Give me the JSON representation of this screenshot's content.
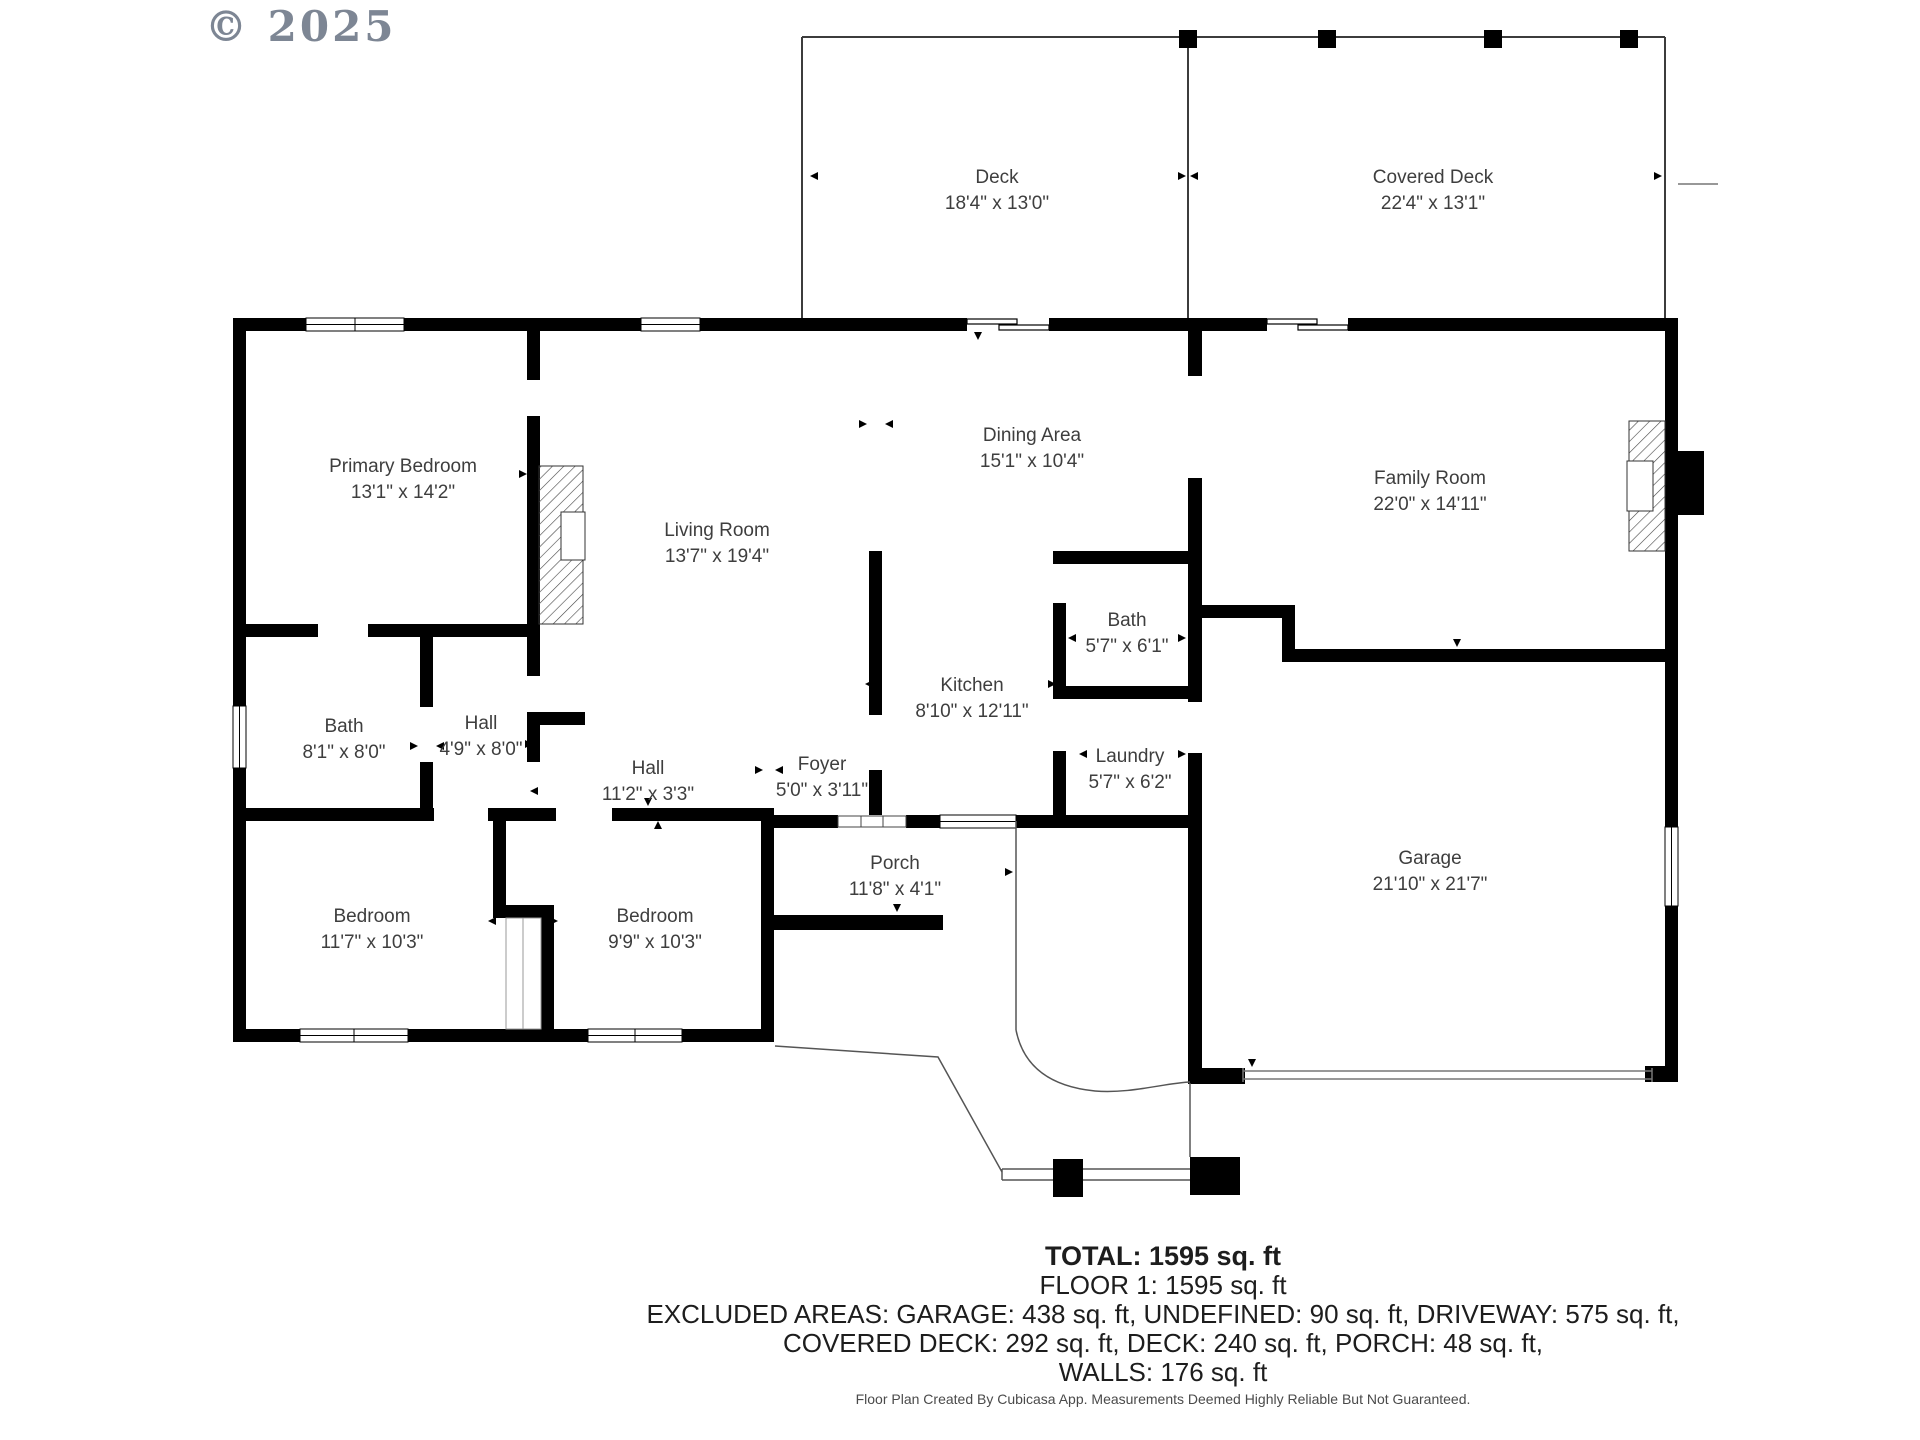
{
  "copyright": "© 2025",
  "rooms": [
    {
      "id": "deck",
      "name": "Deck",
      "dims": "18'4\" x 13'0\"",
      "cx": 997,
      "cy": 191
    },
    {
      "id": "covered-deck",
      "name": "Covered Deck",
      "dims": "22'4\" x 13'1\"",
      "cx": 1433,
      "cy": 191
    },
    {
      "id": "primary-bedroom",
      "name": "Primary Bedroom",
      "dims": "13'1\" x 14'2\"",
      "cx": 403,
      "cy": 480
    },
    {
      "id": "dining-area",
      "name": "Dining Area",
      "dims": "15'1\" x 10'4\"",
      "cx": 1032,
      "cy": 449
    },
    {
      "id": "family-room",
      "name": "Family Room",
      "dims": "22'0\" x 14'11\"",
      "cx": 1430,
      "cy": 492
    },
    {
      "id": "living-room",
      "name": "Living Room",
      "dims": "13'7\" x 19'4\"",
      "cx": 717,
      "cy": 544
    },
    {
      "id": "bath-upper",
      "name": "Bath",
      "dims": "5'7\" x 6'1\"",
      "cx": 1127,
      "cy": 634
    },
    {
      "id": "kitchen",
      "name": "Kitchen",
      "dims": "8'10\" x 12'11\"",
      "cx": 972,
      "cy": 699
    },
    {
      "id": "bath-left",
      "name": "Bath",
      "dims": "8'1\" x 8'0\"",
      "cx": 344,
      "cy": 740
    },
    {
      "id": "hall-small",
      "name": "Hall",
      "dims": "4'9\" x 8'0\"",
      "cx": 481,
      "cy": 737
    },
    {
      "id": "hall-long",
      "name": "Hall",
      "dims": "11'2\" x 3'3\"",
      "cx": 648,
      "cy": 782
    },
    {
      "id": "foyer",
      "name": "Foyer",
      "dims": "5'0\" x 3'11\"",
      "cx": 822,
      "cy": 778
    },
    {
      "id": "laundry",
      "name": "Laundry",
      "dims": "5'7\" x 6'2\"",
      "cx": 1130,
      "cy": 770
    },
    {
      "id": "porch",
      "name": "Porch",
      "dims": "11'8\" x 4'1\"",
      "cx": 895,
      "cy": 877
    },
    {
      "id": "garage",
      "name": "Garage",
      "dims": "21'10\" x 21'7\"",
      "cx": 1430,
      "cy": 872
    },
    {
      "id": "bedroom-left",
      "name": "Bedroom",
      "dims": "11'7\" x 10'3\"",
      "cx": 372,
      "cy": 930
    },
    {
      "id": "bedroom-right",
      "name": "Bedroom",
      "dims": "9'9\" x 10'3\"",
      "cx": 655,
      "cy": 930
    }
  ],
  "summary": {
    "total": "TOTAL: 1595 sq. ft",
    "floor": "FLOOR 1: 1595 sq. ft",
    "excluded_line1": "EXCLUDED AREAS: GARAGE: 438 sq. ft, UNDEFINED: 90 sq. ft, DRIVEWAY: 575 sq. ft,",
    "excluded_line2": "COVERED DECK: 292 sq. ft, DECK: 240 sq. ft, PORCH: 48 sq. ft,",
    "walls": "WALLS: 176 sq. ft"
  },
  "footer": "Floor Plan Created By Cubicasa App. Measurements Deemed Highly Reliable But Not Guaranteed.",
  "colors": {
    "wall": "#000000",
    "text": "#3e3e3e",
    "copyright": "#7d8694",
    "thin_line": "#555555"
  }
}
